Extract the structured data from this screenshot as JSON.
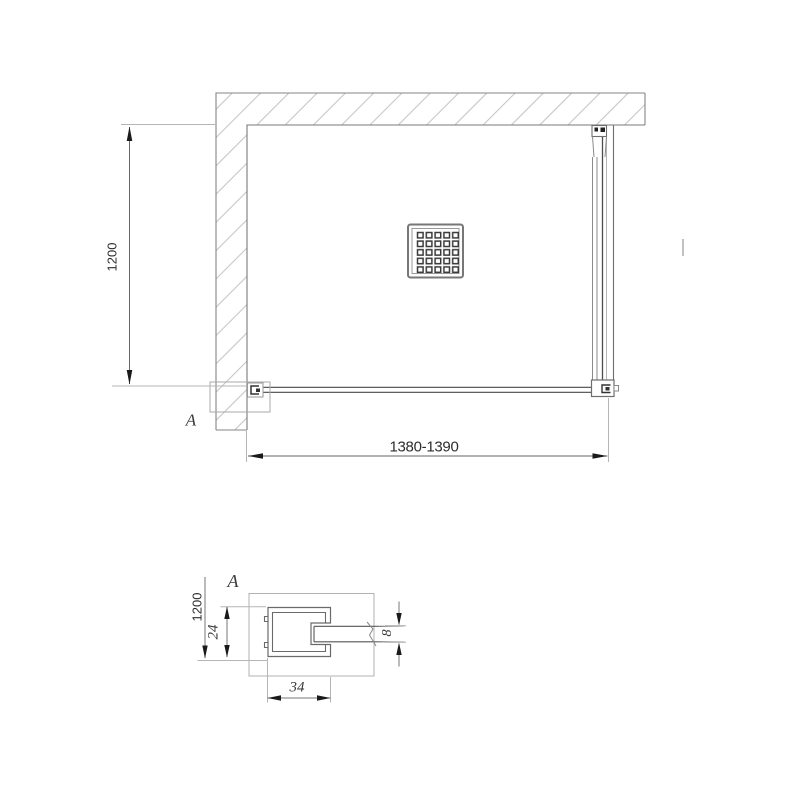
{
  "plan_view": {
    "depth_dimension": "1200",
    "width_dimension": "1380-1390",
    "detail_marker": "A"
  },
  "detail_view": {
    "label": "A",
    "height_dimension": "1200",
    "profile_depth": "24",
    "glass_thickness": "8",
    "profile_width": "34"
  },
  "colors": {
    "background": "#ffffff",
    "line_dark": "#3a3a3a",
    "line_medium": "#6e6e6e",
    "hatch": "#c6c6c6",
    "extension_line": "#b5b5b5"
  }
}
